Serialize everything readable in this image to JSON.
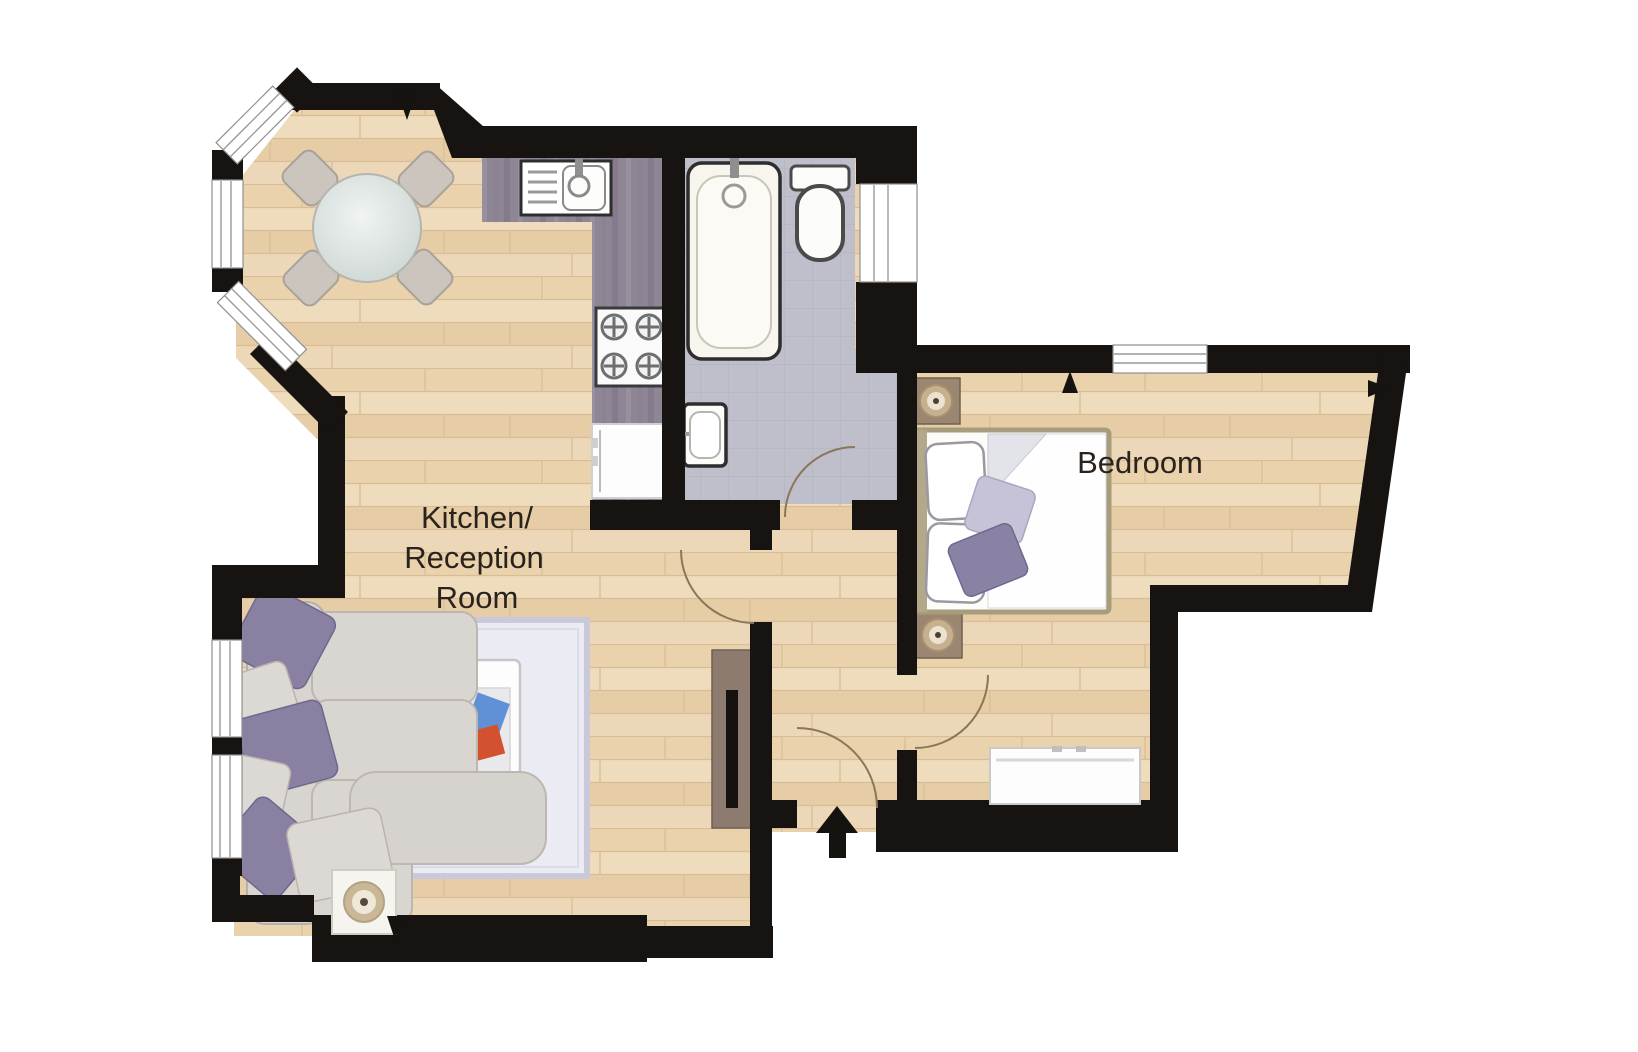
{
  "floorplan": {
    "type": "apartment-floor-plan",
    "rooms": [
      {
        "id": "kitchen_reception",
        "label_lines": [
          "Kitchen/",
          "Reception",
          "Room"
        ]
      },
      {
        "id": "bedroom",
        "label_lines": [
          "Bedroom"
        ]
      },
      {
        "id": "bathroom",
        "label_lines": []
      },
      {
        "id": "hallway",
        "label_lines": []
      }
    ],
    "fixtures": [
      "dining-table",
      "dining-chairs",
      "kitchen-sink",
      "kitchen-hob",
      "washing-machine",
      "bathtub",
      "toilet",
      "hand-basin",
      "corner-sofa",
      "rug",
      "coffee-table",
      "side-table-lamp",
      "radiator",
      "double-bed",
      "nightstand-lamp",
      "nightstand-lamp",
      "low-wardrobe",
      "entrance-arrow"
    ],
    "colors": {
      "wall": "#171310",
      "wood_floor": "#ead4b0",
      "wood_seam": "#d8bd96",
      "tile_floor": "#bfbfcc",
      "tile_line": "#b2b2c2",
      "counter": "#8e8595",
      "rug": "#ebebf3",
      "rug_border": "#c9c9da",
      "sofa": "#d8d4d0",
      "sofa_edge": "#b5b0ab",
      "cushion_purple": "#8a80a2",
      "cushion_light": "#dcd8d4",
      "bed_frame": "#a79d7c",
      "nightstand": "#9b8771",
      "lamp_ring": "#c6b08f",
      "radiator": "#8d7b6f",
      "door_arc": "#8a7757",
      "label_text": "#2a231d",
      "tray_blue": "#6090d6",
      "tray_red": "#d4512f"
    }
  }
}
